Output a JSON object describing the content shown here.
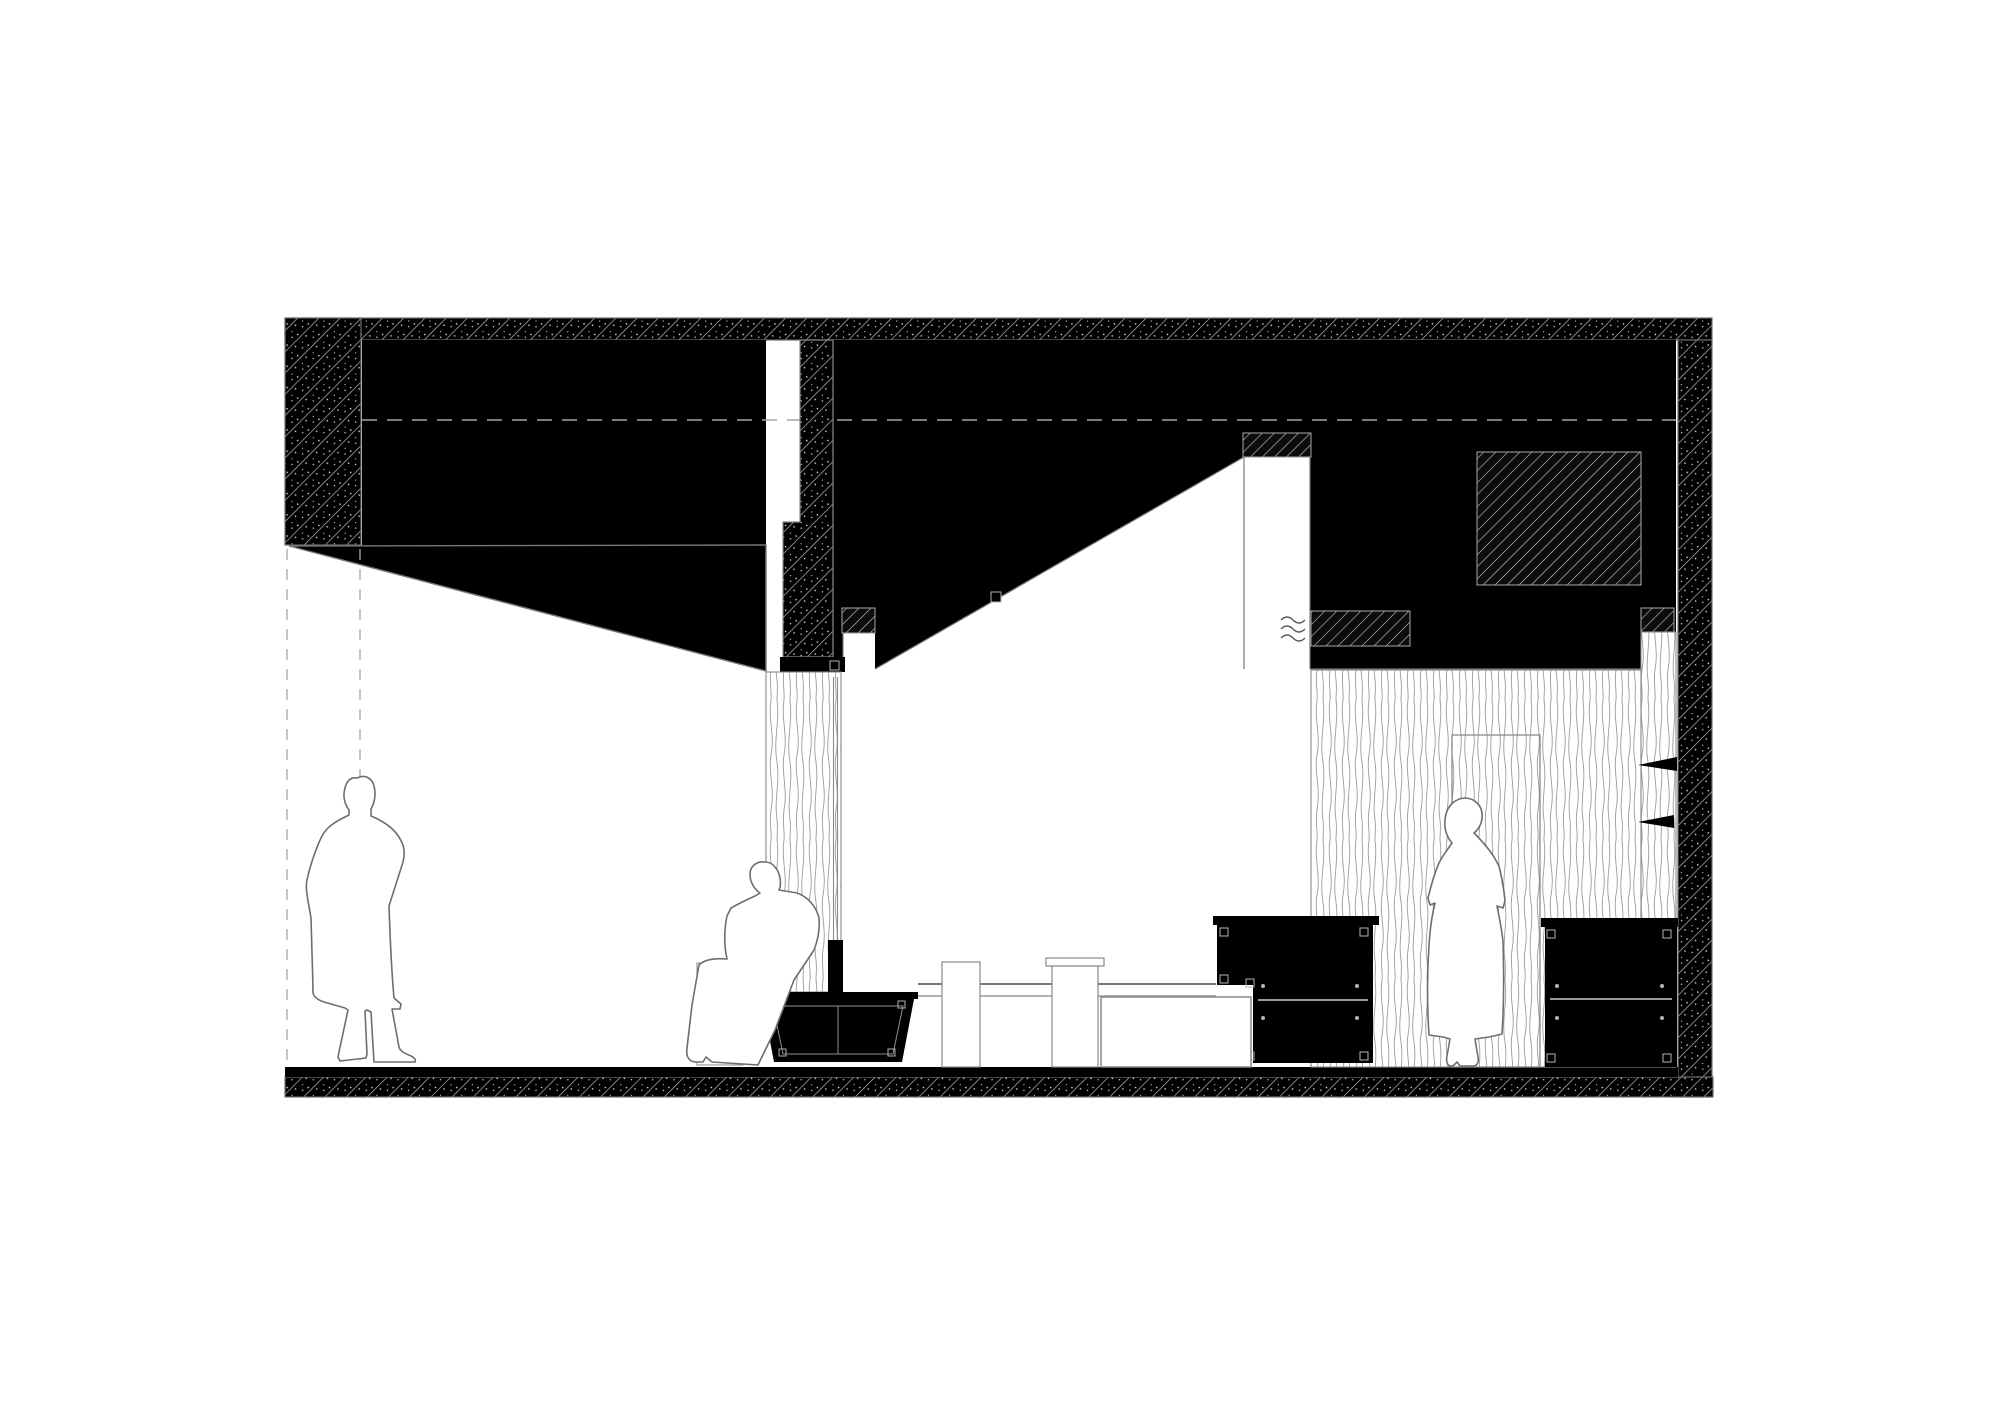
{
  "scene": {
    "kind": "architectural-section-drawing",
    "text_content_visible": "none",
    "figure_count": 3,
    "room_count": 2
  },
  "colors": {
    "paper": "#ffffff",
    "ink": "#000000",
    "outline": "#6e6e6e",
    "detail_line": "#8f8f8f",
    "marker_line": "#b5b5b5",
    "dash_line": "#a6a6a6",
    "hatch_line": "#c9c9c9",
    "wood_line": "#9c9c9c",
    "vent_line": "#555555"
  },
  "figures": {
    "man": {
      "label": "standing-figure-long-coat"
    },
    "seated": {
      "label": "seated-figure-on-stool"
    },
    "woman": {
      "label": "standing-figure-at-door"
    }
  },
  "furniture": {
    "cabinets": 3,
    "drawer_handle_dots_per_cabinet": 4,
    "tables": 1,
    "stools": 1,
    "wall_shelves": 2
  }
}
